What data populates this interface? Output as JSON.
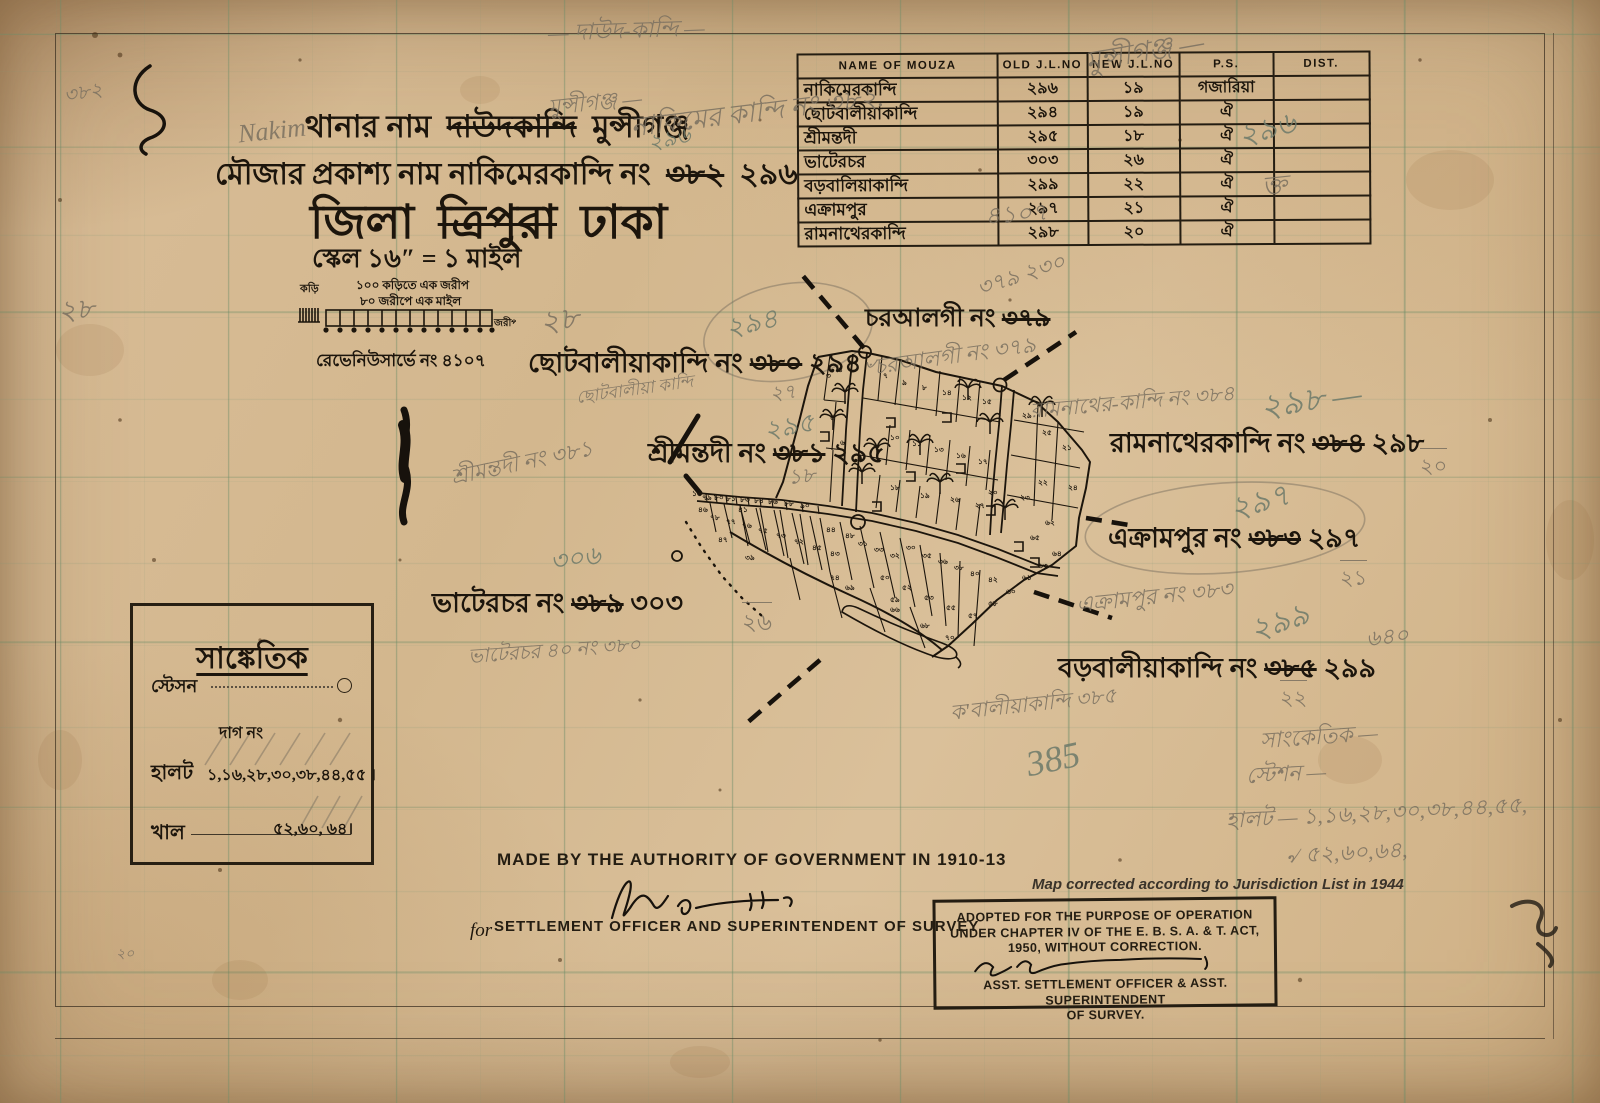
{
  "colors": {
    "paper": "#d8bd96",
    "ink": "#1c150c",
    "pencil": "#7a7060",
    "green_pencil": "#6d7a6a",
    "grid": "#6e8a64"
  },
  "title_block": {
    "line1_label": "থানার নাম",
    "line1_struck": "দাউদকান্দি",
    "line1_new": "মুন্সীগঞ্জ",
    "line2_label": "মৌজার প্রকাশ্য নাম  নাকিমেরকান্দি নং",
    "line2_struck": "৩৮২",
    "line2_new": "২৯৬",
    "line3_label": "জিলা",
    "line3_struck": "ত্রিপুরা",
    "line3_new": "ঢাকা",
    "scale_line": "স্কেল ১৬″ = ১ মাইল",
    "scale_note1": "১০০ কড়িতে এক জরীপ",
    "scale_note2": "৮০ জরীপে এক মাইল",
    "scale_left_label": "কড়ি",
    "scale_right_label": "জরীপ",
    "revenue_note": "রেভেনিউসার্ভে নং ৪১০৭"
  },
  "mouza_table": {
    "headers": [
      "NAME OF MOUZA",
      "OLD J.L.NO",
      "NEW J.L.NO",
      "P.S.",
      "DIST."
    ],
    "rows": [
      {
        "name": "নাকিমেরকান্দি",
        "old": "২৯৬",
        "new": "১৯",
        "ps": "গজারিয়া",
        "dist": ""
      },
      {
        "name": "ছোটবালীয়াকান্দি",
        "old": "২৯৪",
        "new": "১৯",
        "ps": "ঐ",
        "dist": ""
      },
      {
        "name": "শ্রীমন্তদী",
        "old": "২৯৫",
        "new": "১৮",
        "ps": "ঐ",
        "dist": ""
      },
      {
        "name": "ভাটেরচর",
        "old": "৩০৩",
        "new": "২৬",
        "ps": "ঐ",
        "dist": ""
      },
      {
        "name": "বড়বালিয়াকান্দি",
        "old": "২৯৯",
        "new": "২২",
        "ps": "ঐ",
        "dist": ""
      },
      {
        "name": "এক্রামপুর",
        "old": "২৯৭",
        "new": "২১",
        "ps": "ঐ",
        "dist": ""
      },
      {
        "name": "রামনাথেরকান্দি",
        "old": "২৯৮",
        "new": "২০",
        "ps": "ঐ",
        "dist": ""
      }
    ]
  },
  "map_labels": {
    "charalgi": {
      "prefix": "চরআলগী নং",
      "struck": "৩৭৯",
      "new": ""
    },
    "chhotobaliya": {
      "prefix": "ছোটবালীয়াকান্দি নং",
      "struck": "৩৮০",
      "new": "২৯৪"
    },
    "srimantadi": {
      "prefix": "শ্রীমন্তদী নং",
      "struck": "৩৮১",
      "new": "২৯৫"
    },
    "bhaterchar": {
      "prefix": "ভাটেরচর নং",
      "struck": "৩৮৯",
      "new": "৩০৩"
    },
    "ramnather": {
      "prefix": "রামনাথেরকান্দি নং",
      "struck": "৩৮৪",
      "new": "২৯৮"
    },
    "ekrampur": {
      "prefix": "এক্রামপুর নং",
      "struck": "৩৮৩",
      "new": "২৯৭"
    },
    "barabaliya": {
      "prefix": "বড়বালীয়াকান্দি নং",
      "struck": "৩৮৫",
      "new": "২৯৯"
    }
  },
  "legend": {
    "title": "সাঙ্কেতিক",
    "station_label": "স্টেসন",
    "dag_label": "দাগ নং",
    "halot_label": "হালট",
    "halot_values": "১,১৬,২৮,৩০,৩৮,৪৪,৫৫ ।",
    "khal_label": "খাল",
    "khal_values": "৫২,৬০, ৬৪।"
  },
  "footer": {
    "authority_line": "MADE BY THE AUTHORITY OF GOVERNMENT IN 1910-13",
    "for_prefix": "for",
    "officer_line": "SETTLEMENT OFFICER AND SUPERINTENDENT OF SURVEY"
  },
  "stamp": {
    "corrected_line": "Map corrected according to Jurisdiction List in 1944",
    "line1": "ADOPTED FOR THE PURPOSE OF OPERATION",
    "line2": "UNDER CHAPTER IV OF THE E. B. S. A. & T. ACT,",
    "line3": "1950, WITHOUT CORRECTION.",
    "line4": "ASST. SETTLEMENT OFFICER & ASST. SUPERINTENDENT",
    "line5": "OF SURVEY."
  },
  "pencil_notes": [
    {
      "t": "৩৮২",
      "x": 64,
      "y": 78,
      "s": 20,
      "r": -10,
      "c": "g"
    },
    {
      "t": "— দাউদ-কান্দি —",
      "x": 548,
      "y": 12,
      "s": 23,
      "r": -2,
      "c": "g"
    },
    {
      "t": "নাকিমের কান্দি নং ৩৮২.",
      "x": 630,
      "y": 92,
      "s": 27,
      "r": -7,
      "c": "g"
    },
    {
      "t": "৪১০৭",
      "x": 985,
      "y": 196,
      "s": 24,
      "r": -4,
      "c": "g"
    },
    {
      "t": "Nakim",
      "x": 238,
      "y": 116,
      "s": 26,
      "r": -6,
      "c": "g"
    },
    {
      "t": "মুন্সীগঞ্জ —",
      "x": 1085,
      "y": 30,
      "s": 28,
      "r": -10,
      "c": "g"
    },
    {
      "t": "২৯৬",
      "x": 1238,
      "y": 105,
      "s": 30,
      "r": -15,
      "c": "gr"
    },
    {
      "t": "ক্ত",
      "x": 1262,
      "y": 165,
      "s": 26,
      "r": -6,
      "c": "g"
    },
    {
      "t": "মুন্সীগঞ্জ —",
      "x": 548,
      "y": 86,
      "s": 22,
      "r": -6,
      "c": "g"
    },
    {
      "t": "২৯৬",
      "x": 648,
      "y": 122,
      "s": 22,
      "r": -12,
      "c": "gr"
    },
    {
      "t": "২৮",
      "x": 540,
      "y": 296,
      "s": 30,
      "r": -8,
      "c": "g"
    },
    {
      "t": "২৮",
      "x": 58,
      "y": 288,
      "s": 28,
      "r": -5,
      "c": "g"
    },
    {
      "t": "২৯৪",
      "x": 726,
      "y": 303,
      "s": 27,
      "r": -12,
      "c": "gr"
    },
    {
      "t": "২৭",
      "x": 770,
      "y": 378,
      "s": 20,
      "r": -5,
      "c": "g"
    },
    {
      "t": "ছোটবালীয়া কান্দি",
      "x": 576,
      "y": 377,
      "s": 17,
      "r": -8,
      "c": "g"
    },
    {
      "t": "২৯৫",
      "x": 764,
      "y": 406,
      "s": 26,
      "r": -10,
      "c": "gr"
    },
    {
      "t": "১৮",
      "x": 788,
      "y": 460,
      "s": 21,
      "r": -5,
      "c": "g"
    },
    {
      "t": "শ্রীমন্তদী নং ৩৮১",
      "x": 450,
      "y": 446,
      "s": 22,
      "r": -12,
      "c": "g"
    },
    {
      "t": "৩০৬",
      "x": 550,
      "y": 538,
      "s": 26,
      "r": -8,
      "c": "gr"
    },
    {
      "t": "২৬",
      "x": 742,
      "y": 602,
      "s": 23,
      "r": 0,
      "c": "g",
      "f": 1
    },
    {
      "t": "ভাটেরচর ৪০ নং ৩৮০",
      "x": 468,
      "y": 636,
      "s": 20,
      "r": -4,
      "c": "g"
    },
    {
      "t": "৺চরআলগী নং ৩৭৯",
      "x": 860,
      "y": 340,
      "s": 22,
      "r": -8,
      "c": "g"
    },
    {
      "t": "৩৭৯  ২৩০",
      "x": 976,
      "y": 258,
      "s": 22,
      "r": -18,
      "c": "g"
    },
    {
      "t": "রামনাথের-কান্দি নং ৩৮৪",
      "x": 1030,
      "y": 386,
      "s": 21,
      "r": -5,
      "c": "g"
    },
    {
      "t": "২৯৮ —",
      "x": 1260,
      "y": 374,
      "s": 33,
      "r": -8,
      "c": "gr"
    },
    {
      "t": "২০",
      "x": 1420,
      "y": 448,
      "s": 21,
      "r": 0,
      "c": "g",
      "f": 1
    },
    {
      "t": "২৯৭",
      "x": 1230,
      "y": 478,
      "s": 31,
      "r": -15,
      "c": "gr"
    },
    {
      "t": "২১",
      "x": 1340,
      "y": 560,
      "s": 21,
      "r": 0,
      "c": "g",
      "f": 1
    },
    {
      "t": "এক্রামপুর নং ৩৮৩",
      "x": 1076,
      "y": 580,
      "s": 22,
      "r": -6,
      "c": "g"
    },
    {
      "t": "২৯৯",
      "x": 1250,
      "y": 598,
      "s": 31,
      "r": -18,
      "c": "gr"
    },
    {
      "t": "৬৪০",
      "x": 1366,
      "y": 620,
      "s": 22,
      "r": -6,
      "c": "g"
    },
    {
      "t": "২২",
      "x": 1280,
      "y": 680,
      "s": 21,
      "r": 0,
      "c": "g",
      "f": 1
    },
    {
      "t": "ক'বালীয়াকান্দি ৩৮৫",
      "x": 950,
      "y": 688,
      "s": 21,
      "r": -6,
      "c": "g"
    },
    {
      "t": "385",
      "x": 1026,
      "y": 738,
      "s": 36,
      "r": -12,
      "c": "gr"
    },
    {
      "t": "সাংকেতিক —",
      "x": 1260,
      "y": 720,
      "s": 22,
      "r": -4,
      "c": "g"
    },
    {
      "t": "স্টেশন —",
      "x": 1246,
      "y": 757,
      "s": 22,
      "r": -3,
      "c": "g"
    },
    {
      "t": "হালট — ১,১৬,২৮,৩০,৩৮,৪৪,৫৫,",
      "x": 1226,
      "y": 796,
      "s": 22,
      "r": -3,
      "c": "g"
    },
    {
      "t": "৵ ৫২,৬০,৬৪,",
      "x": 1286,
      "y": 836,
      "s": 22,
      "r": -3,
      "c": "g"
    },
    {
      "t": "২০",
      "x": 116,
      "y": 942,
      "s": 14,
      "r": 0,
      "c": "g"
    }
  ],
  "parcel_numbers": [
    {
      "n": "৩",
      "x": 236,
      "y": 128
    },
    {
      "n": "৪",
      "x": 248,
      "y": 122
    },
    {
      "n": "৭",
      "x": 293,
      "y": 128
    },
    {
      "n": "৯",
      "x": 312,
      "y": 135
    },
    {
      "n": "৮",
      "x": 332,
      "y": 140
    },
    {
      "n": "১৪",
      "x": 352,
      "y": 145
    },
    {
      "n": "১২",
      "x": 372,
      "y": 150
    },
    {
      "n": "১৫",
      "x": 392,
      "y": 154
    },
    {
      "n": "৫",
      "x": 240,
      "y": 170
    },
    {
      "n": "৬",
      "x": 250,
      "y": 195
    },
    {
      "n": "১০",
      "x": 300,
      "y": 190
    },
    {
      "n": "১১",
      "x": 322,
      "y": 196
    },
    {
      "n": "১৩",
      "x": 344,
      "y": 202
    },
    {
      "n": "১৬",
      "x": 366,
      "y": 208
    },
    {
      "n": "১৭",
      "x": 388,
      "y": 214
    },
    {
      "n": "২৯",
      "x": 432,
      "y": 168
    },
    {
      "n": "২৫",
      "x": 452,
      "y": 185
    },
    {
      "n": "২১",
      "x": 472,
      "y": 200
    },
    {
      "n": "২৪",
      "x": 478,
      "y": 240
    },
    {
      "n": "২২",
      "x": 448,
      "y": 235
    },
    {
      "n": "২৩",
      "x": 430,
      "y": 250
    },
    {
      "n": "২০",
      "x": 398,
      "y": 245
    },
    {
      "n": "১৮",
      "x": 300,
      "y": 240
    },
    {
      "n": "১৯",
      "x": 330,
      "y": 248
    },
    {
      "n": "২৬",
      "x": 360,
      "y": 252
    },
    {
      "n": "২৭",
      "x": 385,
      "y": 258
    },
    {
      "n": "৭৯",
      "x": 112,
      "y": 250
    },
    {
      "n": "৮০",
      "x": 124,
      "y": 250
    },
    {
      "n": "৮১",
      "x": 136,
      "y": 251
    },
    {
      "n": "৮৩",
      "x": 150,
      "y": 252
    },
    {
      "n": "৮৪",
      "x": 164,
      "y": 253
    },
    {
      "n": "৮৬",
      "x": 178,
      "y": 254
    },
    {
      "n": "৮৮",
      "x": 194,
      "y": 256
    },
    {
      "n": "৯০",
      "x": 210,
      "y": 258
    },
    {
      "n": "৭৮",
      "x": 120,
      "y": 270
    },
    {
      "n": "৭৭",
      "x": 136,
      "y": 274
    },
    {
      "n": "৭৬",
      "x": 152,
      "y": 278
    },
    {
      "n": "৭৫",
      "x": 168,
      "y": 283
    },
    {
      "n": "৭৩",
      "x": 186,
      "y": 288
    },
    {
      "n": "৭২",
      "x": 204,
      "y": 294
    },
    {
      "n": "৪৫",
      "x": 222,
      "y": 300
    },
    {
      "n": "৪১",
      "x": 148,
      "y": 262
    },
    {
      "n": "৪৩",
      "x": 240,
      "y": 306
    },
    {
      "n": "৪৪",
      "x": 236,
      "y": 282
    },
    {
      "n": "৪৭",
      "x": 128,
      "y": 292
    },
    {
      "n": "৪৬",
      "x": 108,
      "y": 262
    },
    {
      "n": "৪৮",
      "x": 255,
      "y": 288
    },
    {
      "n": "৩১",
      "x": 268,
      "y": 296
    },
    {
      "n": "৩৩",
      "x": 284,
      "y": 302
    },
    {
      "n": "৩২",
      "x": 300,
      "y": 308
    },
    {
      "n": "৩০",
      "x": 316,
      "y": 300
    },
    {
      "n": "৩৫",
      "x": 332,
      "y": 308
    },
    {
      "n": "৩৬",
      "x": 348,
      "y": 314
    },
    {
      "n": "৩৮",
      "x": 364,
      "y": 320
    },
    {
      "n": "৪০",
      "x": 380,
      "y": 326
    },
    {
      "n": "৪২",
      "x": 398,
      "y": 332
    },
    {
      "n": "৫০",
      "x": 290,
      "y": 330
    },
    {
      "n": "৫২",
      "x": 312,
      "y": 340
    },
    {
      "n": "৫৩",
      "x": 334,
      "y": 350
    },
    {
      "n": "৫৫",
      "x": 356,
      "y": 360
    },
    {
      "n": "৫৭",
      "x": 378,
      "y": 368
    },
    {
      "n": "৫৮",
      "x": 398,
      "y": 356
    },
    {
      "n": "৬০",
      "x": 416,
      "y": 344
    },
    {
      "n": "৬১",
      "x": 432,
      "y": 330
    },
    {
      "n": "৬৩",
      "x": 448,
      "y": 318
    },
    {
      "n": "৬৪",
      "x": 462,
      "y": 306
    },
    {
      "n": "৬৬",
      "x": 300,
      "y": 362
    },
    {
      "n": "৬৮",
      "x": 330,
      "y": 378
    },
    {
      "n": "৭০",
      "x": 355,
      "y": 390
    },
    {
      "n": "৬৯",
      "x": 255,
      "y": 340
    },
    {
      "n": "৩৯",
      "x": 155,
      "y": 310
    },
    {
      "n": "৬৫",
      "x": 440,
      "y": 290
    },
    {
      "n": "৬২",
      "x": 455,
      "y": 275
    },
    {
      "n": "১৬",
      "x": 102,
      "y": 246
    },
    {
      "n": "৭৪",
      "x": 240,
      "y": 330
    },
    {
      "n": "৫৯",
      "x": 300,
      "y": 352
    }
  ]
}
